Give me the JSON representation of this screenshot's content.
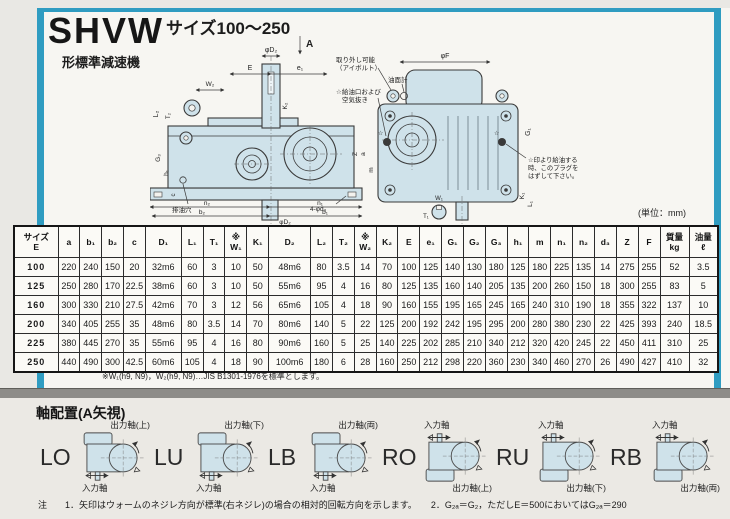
{
  "page": {
    "title": "SHVW",
    "subtitle": "形標準減速機",
    "size_range": "サイズ100～250",
    "unit_note": "(単位：mm)",
    "table_footnote": "※W₁(h9, N9)，W₂(h9, N9)…JIS B1301-1976を標準とします。"
  },
  "colors": {
    "frame_blue": "#2f9cc1",
    "drawing_fill": "#cfe2ea",
    "page_bg": "#f7f6f2",
    "bottom_bg": "#ebe9e4"
  },
  "drawing": {
    "view_arrow": "A",
    "star": "☆",
    "dims": {
      "phiD2": "φD₂",
      "E": "E",
      "e1": "e₁",
      "W2": "W₂",
      "L2": "L₂",
      "T2": "T₂",
      "K2": "K₂",
      "G3": "G₃",
      "h1": "h₁",
      "c": "c",
      "n2": "n₂",
      "n1": "n₁",
      "b2": "b₂",
      "b1": "b₁",
      "phiD2b": "φD₂",
      "Z": "Z",
      "a": "a",
      "m": "m",
      "phiF": "φF",
      "G1": "G₁",
      "K1": "K₁",
      "L1": "L₁",
      "W1": "W₁",
      "T1": "T₁"
    },
    "callouts": {
      "eyebolt1": "取り外し可能",
      "eyebolt2": "（アイボルト）",
      "oil_gauge": "油面計",
      "oil_fill1": "☆給油口および",
      "oil_fill2": "空気抜き",
      "drain": "排油穴",
      "holes": "4-φd₃",
      "plug1": "☆印より給油する",
      "plug2": "時、このプラグを",
      "plug3": "はずして下さい。"
    }
  },
  "table": {
    "headers": [
      [
        "サイズ",
        "E"
      ],
      [
        "a"
      ],
      [
        "b₁"
      ],
      [
        "b₂"
      ],
      [
        "c"
      ],
      [
        "D₁"
      ],
      [
        "L₁"
      ],
      [
        "T₁"
      ],
      [
        "※",
        "W₁"
      ],
      [
        "K₁"
      ],
      [
        "D₂"
      ],
      [
        "L₂"
      ],
      [
        "T₂"
      ],
      [
        "※",
        "W₂"
      ],
      [
        "K₂"
      ],
      [
        "E"
      ],
      [
        "e₁"
      ],
      [
        "G₁"
      ],
      [
        "G₂"
      ],
      [
        "G₃"
      ],
      [
        "h₁"
      ],
      [
        "m"
      ],
      [
        "n₁"
      ],
      [
        "n₂"
      ],
      [
        "d₃"
      ],
      [
        "Z"
      ],
      [
        "F"
      ],
      [
        "質量",
        "kg"
      ],
      [
        "油量",
        "ℓ"
      ]
    ],
    "rows": [
      [
        "100",
        "220",
        "240",
        "150",
        "20",
        "32m6",
        "60",
        "3",
        "10",
        "50",
        "48m6",
        "80",
        "3.5",
        "14",
        "70",
        "100",
        "125",
        "140",
        "130",
        "180",
        "125",
        "180",
        "225",
        "135",
        "14",
        "275",
        "255",
        "52",
        "3.5"
      ],
      [
        "125",
        "250",
        "280",
        "170",
        "22.5",
        "38m6",
        "60",
        "3",
        "10",
        "50",
        "55m6",
        "95",
        "4",
        "16",
        "80",
        "125",
        "135",
        "160",
        "140",
        "205",
        "135",
        "200",
        "260",
        "150",
        "18",
        "300",
        "255",
        "83",
        "5"
      ],
      [
        "160",
        "300",
        "330",
        "210",
        "27.5",
        "42m6",
        "70",
        "3",
        "12",
        "56",
        "65m6",
        "105",
        "4",
        "18",
        "90",
        "160",
        "155",
        "195",
        "165",
        "245",
        "165",
        "240",
        "310",
        "190",
        "18",
        "355",
        "322",
        "137",
        "10"
      ],
      [
        "200",
        "340",
        "405",
        "255",
        "35",
        "48m6",
        "80",
        "3.5",
        "14",
        "70",
        "80m6",
        "140",
        "5",
        "22",
        "125",
        "200",
        "192",
        "242",
        "195",
        "295",
        "200",
        "280",
        "380",
        "230",
        "22",
        "425",
        "393",
        "240",
        "18.5"
      ],
      [
        "225",
        "380",
        "445",
        "270",
        "35",
        "55m6",
        "95",
        "4",
        "16",
        "80",
        "90m6",
        "160",
        "5",
        "25",
        "140",
        "225",
        "202",
        "285",
        "210",
        "340",
        "212",
        "320",
        "420",
        "245",
        "22",
        "450",
        "411",
        "310",
        "25"
      ],
      [
        "250",
        "440",
        "490",
        "300",
        "42.5",
        "60m6",
        "105",
        "4",
        "18",
        "90",
        "100m6",
        "180",
        "6",
        "28",
        "160",
        "250",
        "212",
        "298",
        "220",
        "360",
        "230",
        "340",
        "460",
        "270",
        "26",
        "490",
        "427",
        "410",
        "32"
      ]
    ]
  },
  "shaft_section": {
    "heading": "軸配置(A矢視)",
    "items": [
      {
        "code": "LO",
        "type": "L",
        "output_label": "出力軸(上)",
        "input_label": "入力軸"
      },
      {
        "code": "LU",
        "type": "L",
        "output_label": "出力軸(下)",
        "input_label": "入力軸"
      },
      {
        "code": "LB",
        "type": "L",
        "output_label": "出力軸(両)",
        "input_label": "入力軸"
      },
      {
        "code": "RO",
        "type": "R",
        "output_label": "出力軸(上)",
        "input_label": "入力軸"
      },
      {
        "code": "RU",
        "type": "R",
        "output_label": "出力軸(下)",
        "input_label": "入力軸"
      },
      {
        "code": "RB",
        "type": "R",
        "output_label": "出力軸(両)",
        "input_label": "入力軸"
      }
    ],
    "notes": {
      "label": "注",
      "n1": "1．矢印はウォームのネジレ方向が標準(右ネジレ)の場合の相対的回転方向を示します。",
      "n2": "2．G₂ₐ＝G₂，ただしE＝500においてはG₂ₐ＝290"
    }
  }
}
